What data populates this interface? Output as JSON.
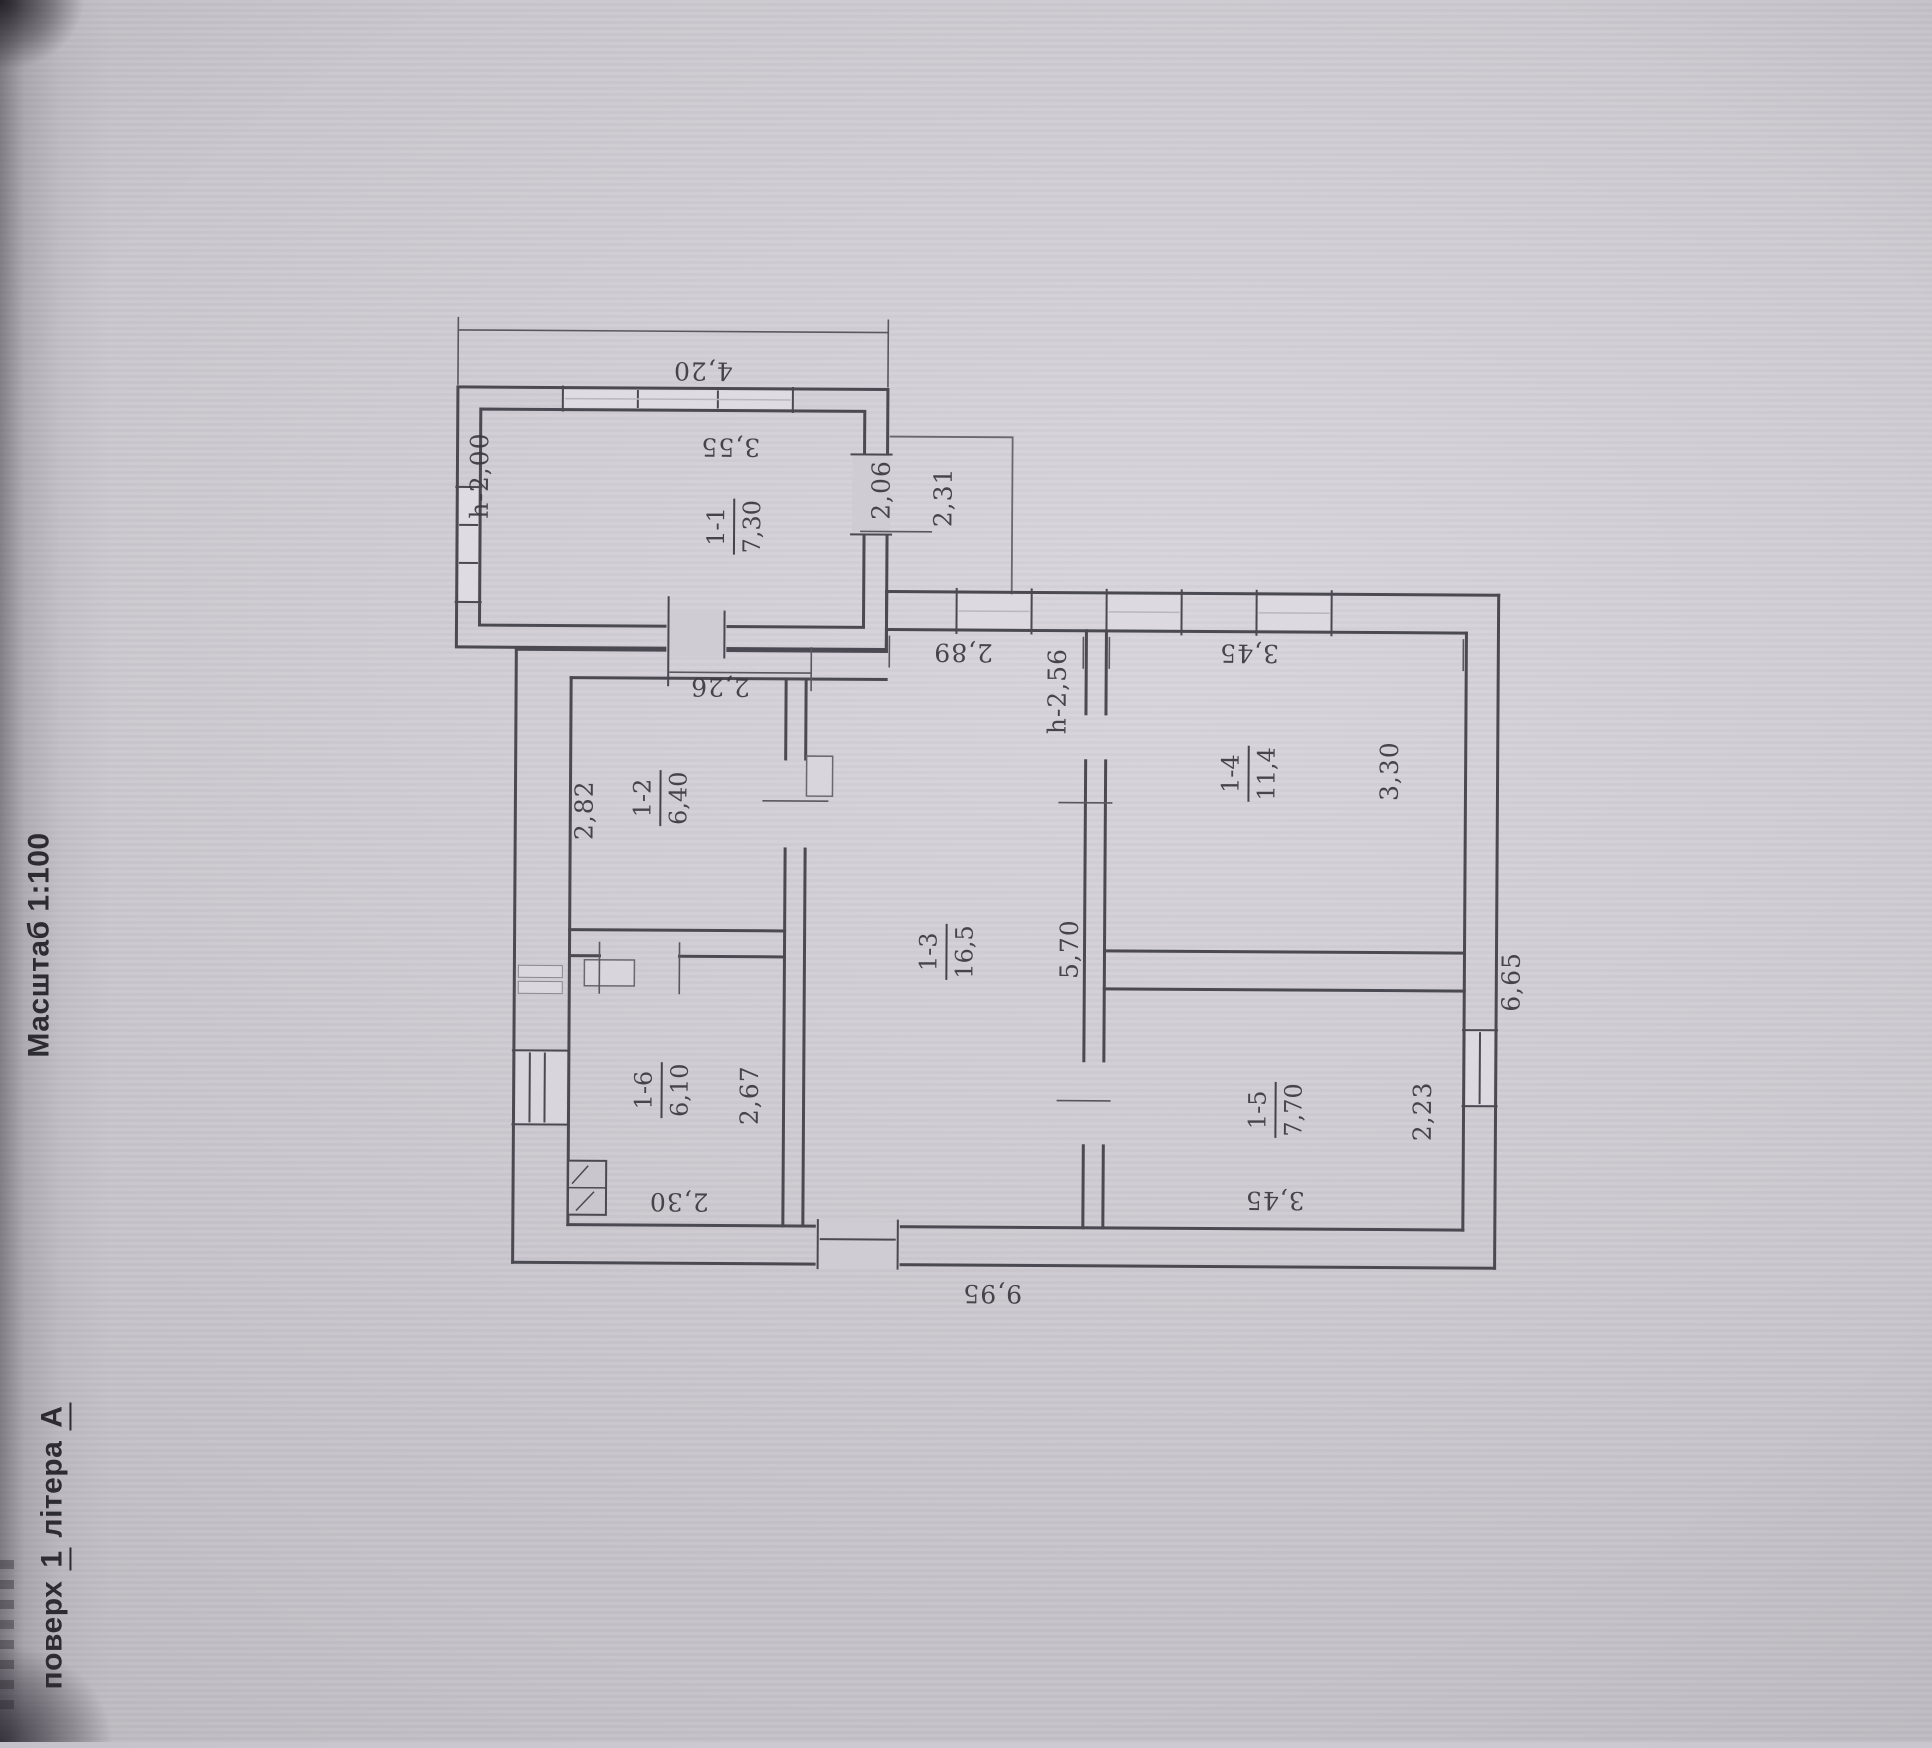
{
  "header": {
    "floor_prefix": "поверх",
    "floor_number": "1",
    "floor_word": "літера",
    "floor_letter": "А",
    "scale_label": "Масштаб 1:100"
  },
  "plan": {
    "rooms": [
      {
        "number": "1-1",
        "area": "7,30"
      },
      {
        "number": "1-2",
        "area": "6,40"
      },
      {
        "number": "1-3",
        "area": "16,5"
      },
      {
        "number": "1-4",
        "area": "11,4"
      },
      {
        "number": "1-5",
        "area": "7,70"
      },
      {
        "number": "1-6",
        "area": "6,10"
      }
    ],
    "dims": {
      "top_overall": "4,20",
      "bottom_overall": "9,95",
      "right_overall": "6,65",
      "r11_width": "3,55",
      "r11_depth": "2,06",
      "r11_height": "h-2,00",
      "porch_width": "2,31",
      "r12_top": "2,26",
      "r12_side": "2,82",
      "r13_top": "2,89",
      "r13_side": "5,70",
      "r13_height": "h-2,56",
      "r14_top": "3,45",
      "r14_side": "3,30",
      "r15_side": "2,23",
      "r15_bottom": "3,45",
      "r16_side": "2,67",
      "r16_bottom": "2,30"
    }
  }
}
